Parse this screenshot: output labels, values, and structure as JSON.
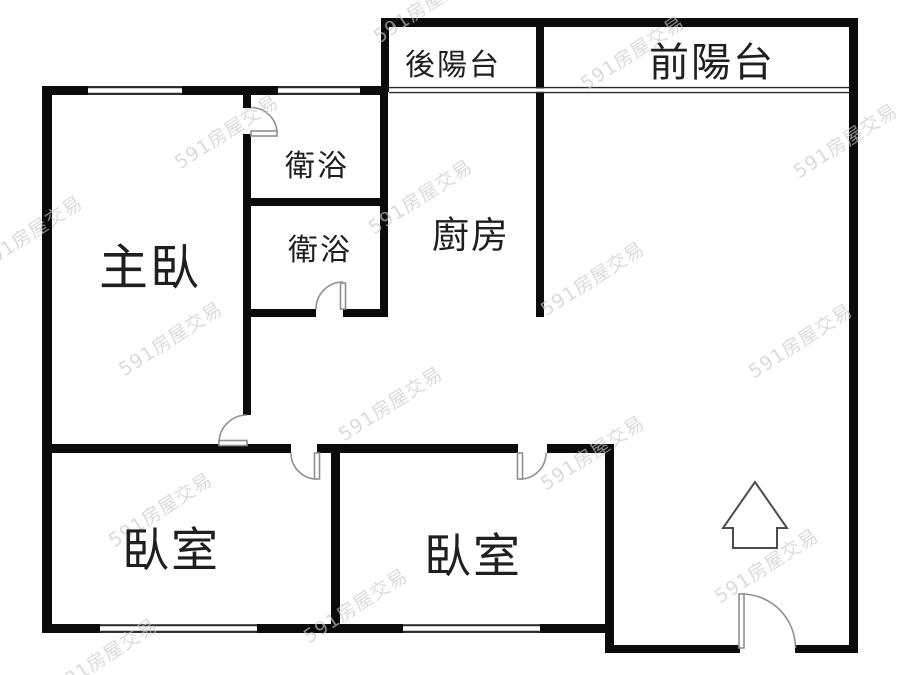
{
  "floorplan": {
    "rooms": {
      "rear_balcony": {
        "label": "後陽台"
      },
      "front_balcony": {
        "label": "前陽台"
      },
      "bathroom_top": {
        "label": "衛浴"
      },
      "bathroom_bottom": {
        "label": "衛浴"
      },
      "kitchen": {
        "label": "廚房"
      },
      "master_bedroom": {
        "label": "主臥"
      },
      "bedroom_left": {
        "label": "臥室"
      },
      "bedroom_middle": {
        "label": "臥室"
      }
    },
    "icons": {
      "north_arrow": "up-arrow"
    },
    "watermark": {
      "text": "591房屋交易",
      "color": "#c8c8c8",
      "rotation_deg": -33,
      "positions": [
        [
          425,
          5
        ],
        [
          632,
          52
        ],
        [
          226,
          131
        ],
        [
          845,
          140
        ],
        [
          420,
          196
        ],
        [
          592,
          278
        ],
        [
          30,
          232
        ],
        [
          170,
          338
        ],
        [
          390,
          403
        ],
        [
          800,
          340
        ],
        [
          592,
          452
        ],
        [
          160,
          509
        ],
        [
          355,
          605
        ],
        [
          766,
          565
        ],
        [
          105,
          655
        ]
      ]
    },
    "colors": {
      "wall": "#0b0b0b",
      "door_arc": "#909090",
      "label_text": "#1f1f1f",
      "background": "#ffffff"
    }
  }
}
